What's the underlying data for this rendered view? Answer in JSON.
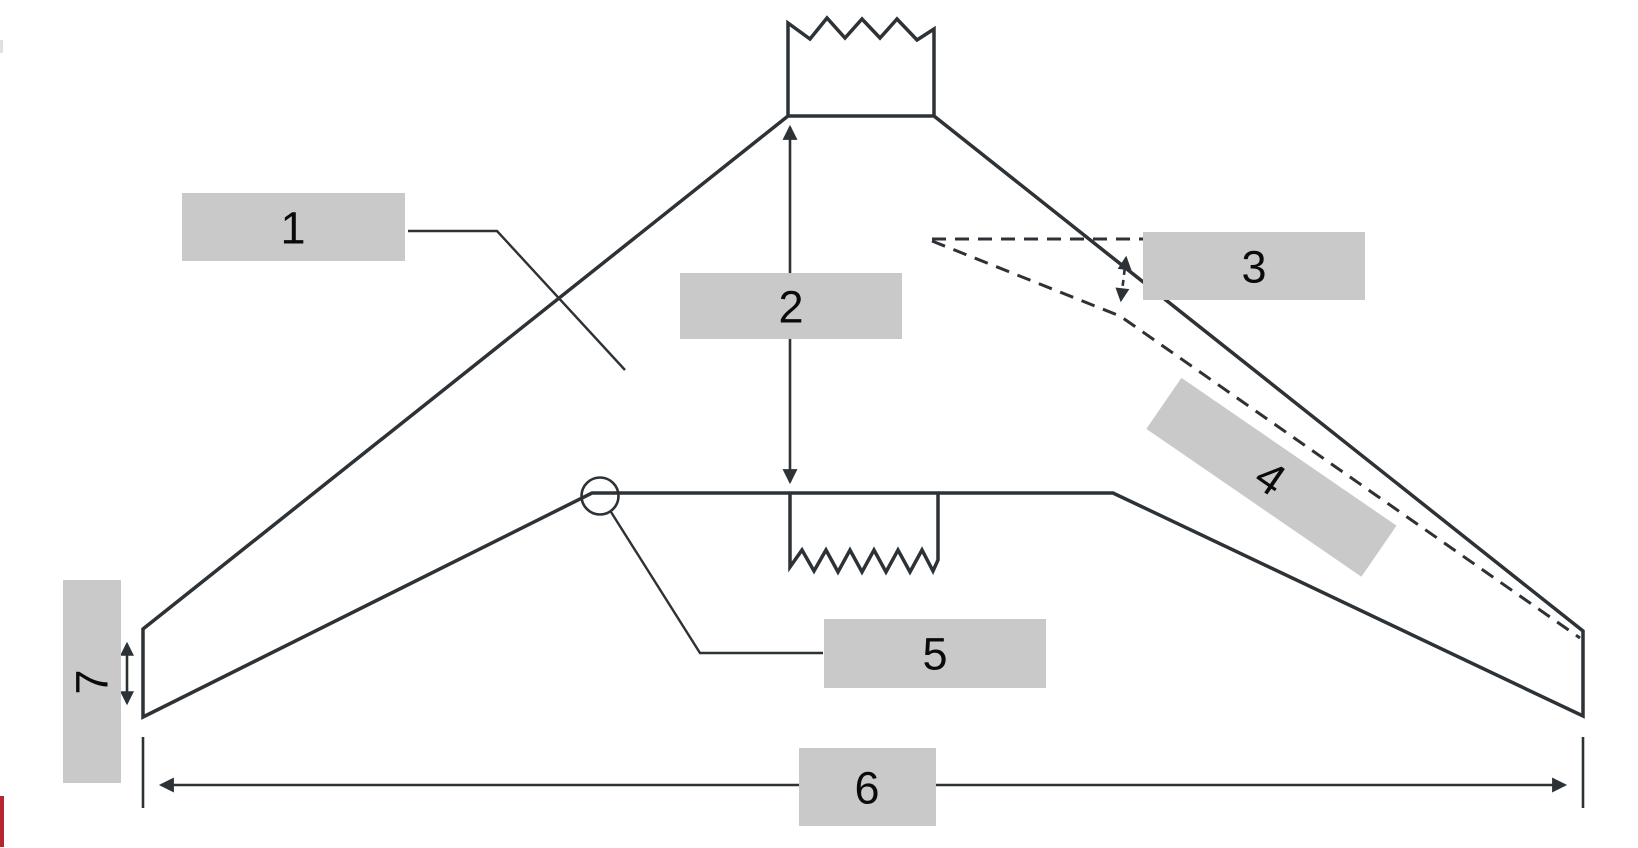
{
  "diagram": {
    "type": "swept-wing planform diagram with numbered callouts",
    "callouts": [
      {
        "label": "1"
      },
      {
        "label": "2"
      },
      {
        "label": "3"
      },
      {
        "label": "4"
      },
      {
        "label": "5"
      },
      {
        "label": "6"
      },
      {
        "label": "7"
      }
    ]
  },
  "colors": {
    "background": "#ffffff",
    "wing_fill": "#68b3bb",
    "outline": "#2d3237",
    "label_box_fill": "#c9c9c9",
    "label_text": "#0a0a0a",
    "logo_fragment_red": "#b52532"
  }
}
